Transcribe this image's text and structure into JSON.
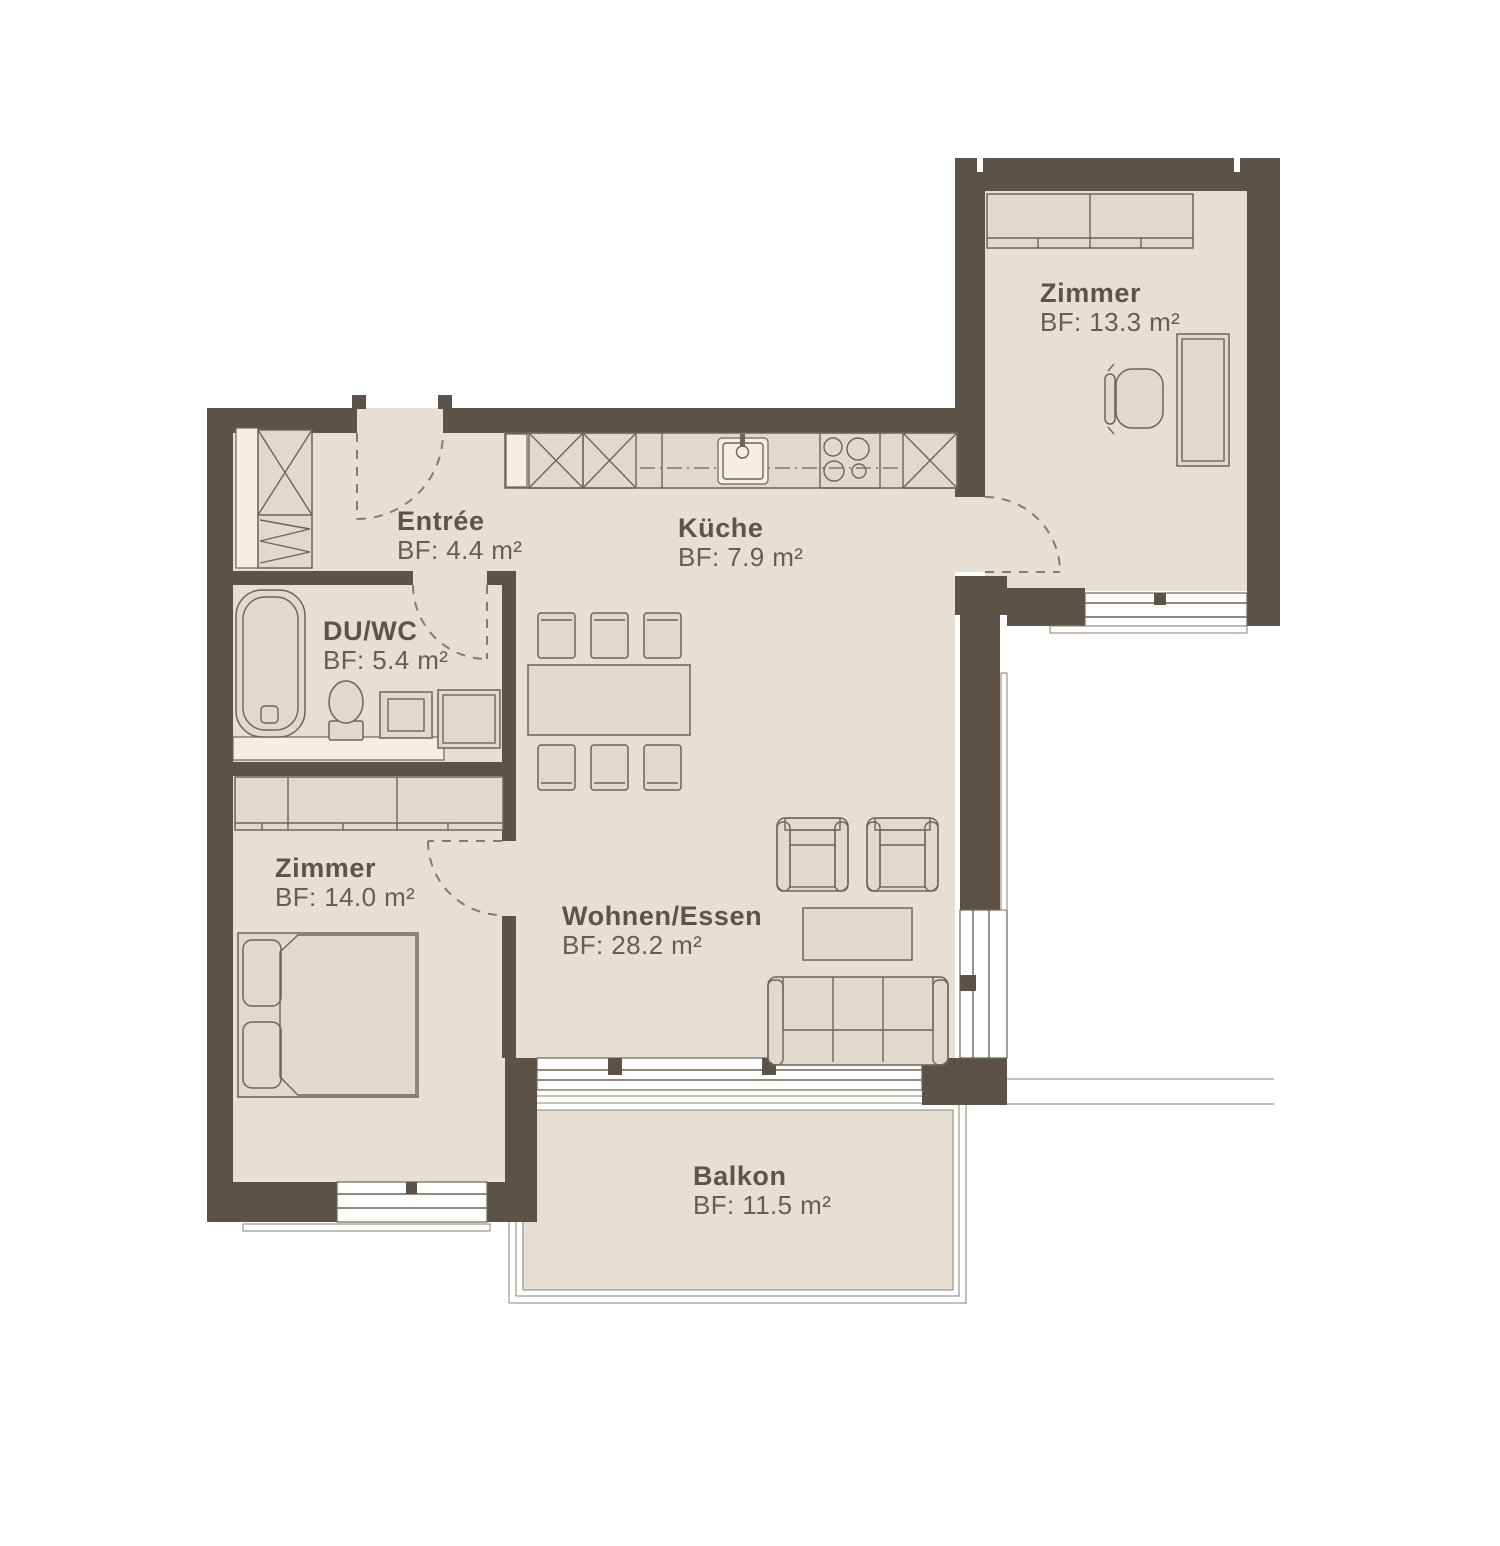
{
  "floorplan": {
    "rooms": [
      {
        "id": "zimmer-top-right",
        "name": "Zimmer",
        "area": "BF: 13.3 m²"
      },
      {
        "id": "entree",
        "name": "Entrée",
        "area": "BF: 4.4 m²"
      },
      {
        "id": "kueche",
        "name": "Küche",
        "area": "BF: 7.9 m²"
      },
      {
        "id": "du-wc",
        "name": "DU/WC",
        "area": "BF: 5.4 m²"
      },
      {
        "id": "zimmer-bottom",
        "name": "Zimmer",
        "area": "BF: 14.0 m²"
      },
      {
        "id": "wohnen-essen",
        "name": "Wohnen/Essen",
        "area": "BF: 28.2 m²"
      },
      {
        "id": "balkon",
        "name": "Balkon",
        "area": "BF: 11.5 m²"
      }
    ],
    "colors": {
      "wall": "#5c5247",
      "floor": "#e7dfd4",
      "furniture": "#e1d9cc",
      "accent_light": "#f4eee3",
      "outline": "#6e6457",
      "text": "#5d5348",
      "background": "#ffffff"
    }
  }
}
